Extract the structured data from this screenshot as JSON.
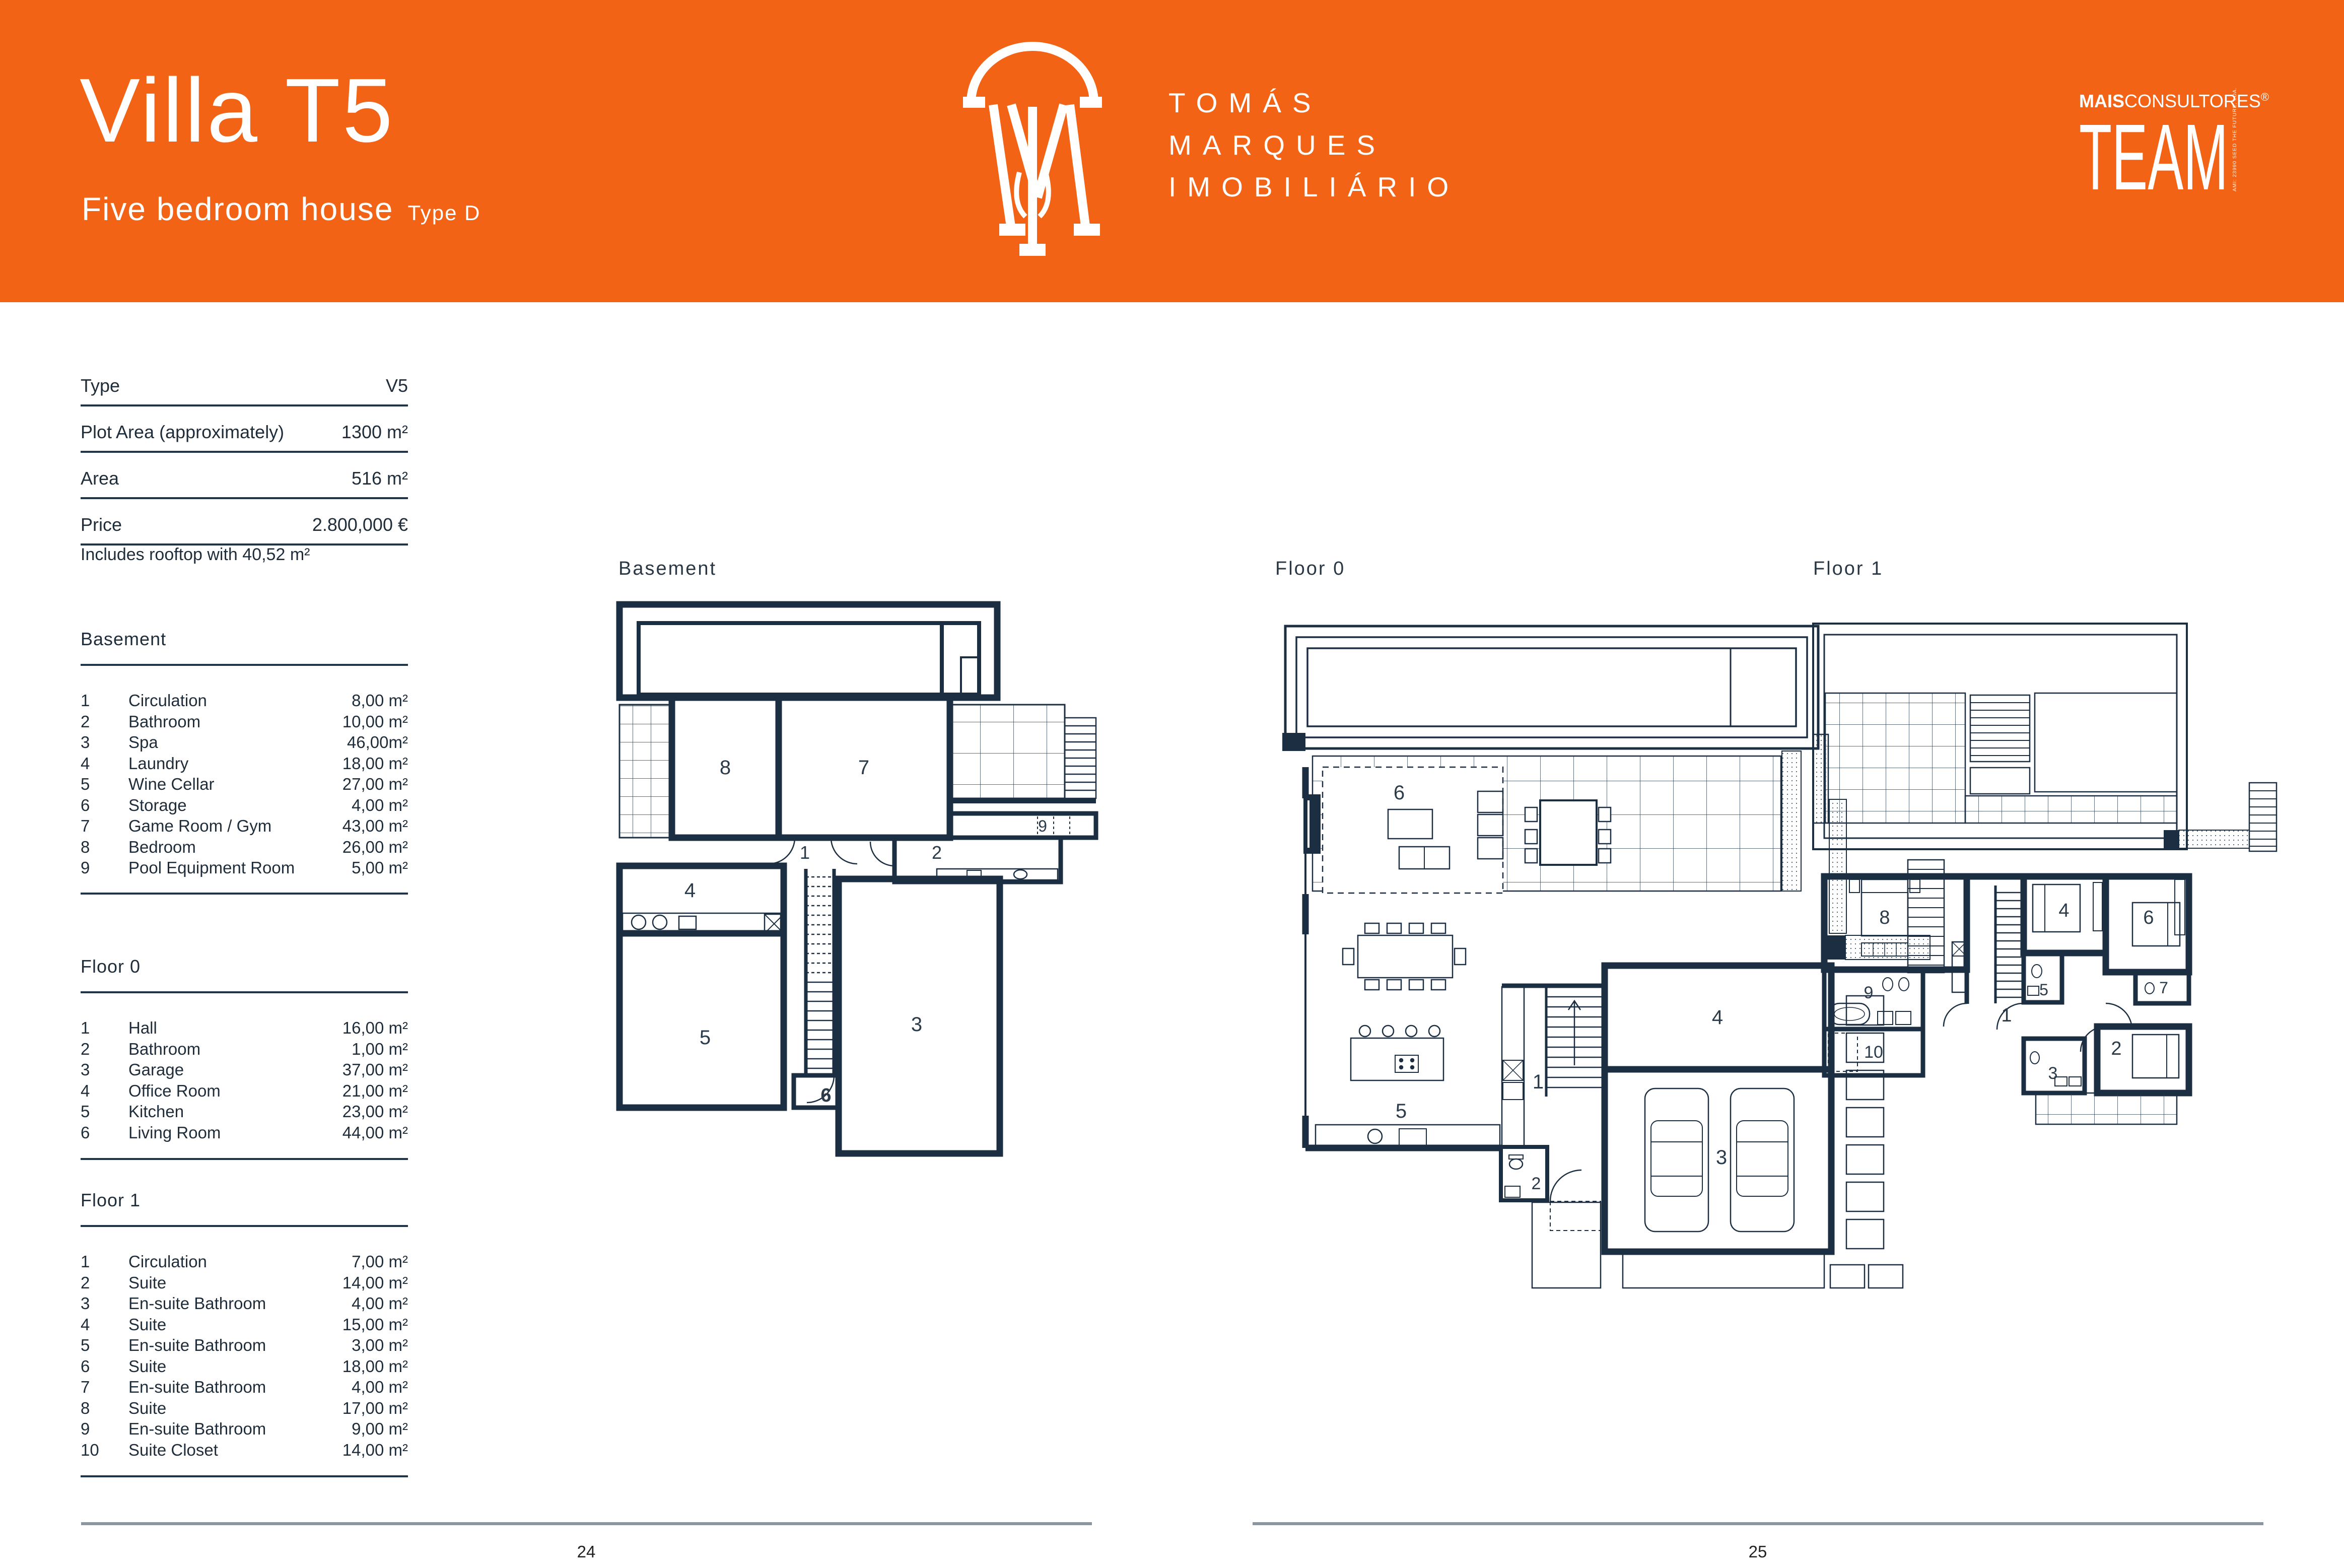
{
  "header": {
    "bg_color": "#F26316",
    "title": "Villa T5",
    "subtitle": "Five bedroom house",
    "type_label": "Type D",
    "brand": {
      "line1": "TOMÁS",
      "line2": "MARQUES",
      "line3": "IMOBILIÁRIO"
    },
    "team": {
      "bold": "MAIS",
      "rest": "CONSULTORES",
      "reg": "®",
      "word": "TEAM",
      "side": "AMI: 23990  SEED THE FUTURE, LDA."
    }
  },
  "specs": {
    "rows": [
      {
        "label": "Type",
        "value": "V5"
      },
      {
        "label": "Plot Area (approximately)",
        "value": "1300 m²"
      },
      {
        "label": "Area",
        "value": "516 m²"
      },
      {
        "label": "Price",
        "value": "2.800,000 €"
      }
    ],
    "note": "Includes rooftop with 40,52 m²"
  },
  "legend": {
    "basement": {
      "title": "Basement",
      "items": [
        {
          "num": "1",
          "name": "Circulation",
          "area": "8,00 m²"
        },
        {
          "num": "2",
          "name": "Bathroom",
          "area": "10,00 m²"
        },
        {
          "num": "3",
          "name": "Spa",
          "area": "46,00m²"
        },
        {
          "num": "4",
          "name": "Laundry",
          "area": "18,00 m²"
        },
        {
          "num": "5",
          "name": "Wine Cellar",
          "area": "27,00 m²"
        },
        {
          "num": "6",
          "name": "Storage",
          "area": "4,00 m²"
        },
        {
          "num": "7",
          "name": "Game Room / Gym",
          "area": "43,00 m²"
        },
        {
          "num": "8",
          "name": "Bedroom",
          "area": "26,00 m²"
        },
        {
          "num": "9",
          "name": "Pool Equipment Room",
          "area": "5,00 m²"
        }
      ]
    },
    "floor0": {
      "title": "Floor 0",
      "items": [
        {
          "num": "1",
          "name": "Hall",
          "area": "16,00 m²"
        },
        {
          "num": "2",
          "name": "Bathroom",
          "area": "1,00 m²"
        },
        {
          "num": "3",
          "name": "Garage",
          "area": "37,00 m²"
        },
        {
          "num": "4",
          "name": "Office Room",
          "area": "21,00 m²"
        },
        {
          "num": "5",
          "name": "Kitchen",
          "area": "23,00 m²"
        },
        {
          "num": "6",
          "name": "Living Room",
          "area": "44,00 m²"
        }
      ]
    },
    "floor1": {
      "title": "Floor 1",
      "items": [
        {
          "num": "1",
          "name": "Circulation",
          "area": "7,00 m²"
        },
        {
          "num": "2",
          "name": "Suite",
          "area": "14,00 m²"
        },
        {
          "num": "3",
          "name": "En-suite Bathroom",
          "area": "4,00 m²"
        },
        {
          "num": "4",
          "name": "Suite",
          "area": "15,00 m²"
        },
        {
          "num": "5",
          "name": "En-suite Bathroom",
          "area": "3,00 m²"
        },
        {
          "num": "6",
          "name": "Suite",
          "area": "18,00 m²"
        },
        {
          "num": "7",
          "name": "En-suite Bathroom",
          "area": "4,00 m²"
        },
        {
          "num": "8",
          "name": "Suite",
          "area": "17,00 m²"
        },
        {
          "num": "9",
          "name": "En-suite Bathroom",
          "area": "9,00 m²"
        },
        {
          "num": "10",
          "name": "Suite Closet",
          "area": "14,00 m²"
        }
      ]
    }
  },
  "plans": {
    "basement_title": "Basement",
    "floor0_title": "Floor 0",
    "floor1_title": "Floor 1",
    "wall_color": "#1B2E42"
  },
  "footer": {
    "left_page": "24",
    "right_page": "25"
  }
}
